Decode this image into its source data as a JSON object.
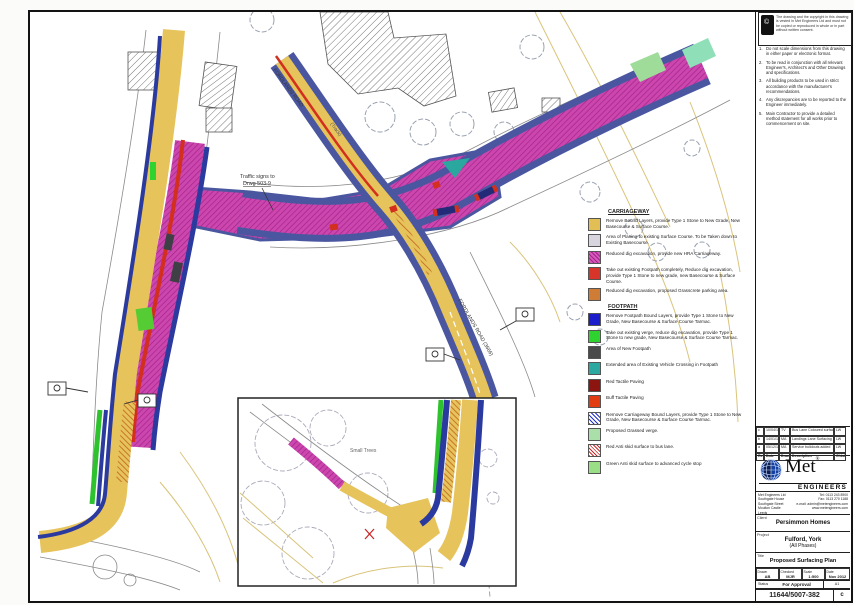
{
  "notes": {
    "copyright": "The drawing and the copyright in this drawing is vested in Met Engineers Ltd and must not be copied or reproduced in whole or in part without written consent.",
    "items": [
      {
        "n": "1.",
        "text": "Do not scale dimensions from this drawing in either paper or electronic format."
      },
      {
        "n": "2.",
        "text": "To be read in conjunction with all relevant Engineer's, Architect's and Other Drawings and specifications."
      },
      {
        "n": "3.",
        "text": "All building products to be used in strict accordance with the manufacturer's recommendations."
      },
      {
        "n": "4.",
        "text": "Any discrepancies are to be reported to the Engineer immediately."
      },
      {
        "n": "5.",
        "text": "Main Contractor to provide a detailed method statement for all works prior to commencement on site."
      }
    ]
  },
  "revisions": {
    "rows": [
      [
        "c",
        "10/04/13",
        "TV",
        "Bus Lane Coloured surface added",
        "LW"
      ],
      [
        "b",
        "14/01/13",
        "MA",
        "Landings Lane Surfacing Plan added",
        "LW"
      ],
      [
        "a",
        "05/12/12",
        "MA",
        "Service buildouts added",
        "LW"
      ]
    ],
    "footer": [
      "Rev",
      "Date",
      "Drawn",
      "Description",
      "Chkd"
    ]
  },
  "logo": {
    "name": "Met",
    "reg": "®",
    "sub": "ENGINEERS"
  },
  "company": {
    "lines": [
      "Met Engineers Ltd",
      "Southgate House",
      "Southgate Street",
      "Moulton Castle",
      "Leeds"
    ],
    "contact": [
      "Tel: 0113 243 8900",
      "Fax: 0113 270 1188",
      "e-mail: admin@metengineers.com",
      "www.metengineers.com"
    ]
  },
  "client": {
    "label": "Client",
    "name": "Persimmon Homes"
  },
  "project": {
    "label": "Project",
    "line1": "Fulford, York",
    "line2": "(All Phases)"
  },
  "title_block": {
    "label": "Title",
    "title": "Proposed Surfacing Plan",
    "drawn_label": "Drawn",
    "drawn": "AB",
    "checked_label": "Checked",
    "checked": "MJR",
    "scale_label": "Scale",
    "scale": "1:500",
    "date_label": "Date",
    "date1": "Nov 2012",
    "date2": "Nov 2012",
    "status_label": "Status",
    "status": "For Approval",
    "size_label": "Original Size",
    "size": "A1",
    "number_label": "Drawing No.",
    "number": "11644/5007-382",
    "rev_label": "Rev",
    "rev": "c"
  },
  "legend": {
    "carriageway": {
      "heading": "CARRIAGEWAY",
      "items": [
        {
          "color": "#e2bf55",
          "label": "Remove Bound Layers, provide Type 1 Stone to New Grade, New Basecourse & Surface Course."
        },
        {
          "color": "#d9d5de",
          "label": "Area of Planing to existing Surface Course. To be Taken down to Existing Basecourse."
        },
        {
          "color": "#cb46ad",
          "pattern": "magenta-hatch",
          "label": "Reduced dig excavation, provide new HRA Carriageway."
        },
        {
          "color": "#d8352a",
          "label": "Take out existing Footpath completely, Reduce dig excavation, provide Type 1 Stone to new grade, new Basecourse & Surface Course."
        },
        {
          "color": "#cf7d36",
          "label": "Reduced dig excavation, proposed Grasscrete parking area."
        }
      ]
    },
    "footpath": {
      "heading": "FOOTPATH",
      "items": [
        {
          "color": "#1c1ecb",
          "label": "Remove Footpath Bound Layers, provide Type 1 Stone to New Grade, New Basecourse & Surface Course Tarmac."
        },
        {
          "color": "#2fd32f",
          "label": "Take out existing verge, reduce dig excavation, provide Type 1 Stone to new grade, New Basecourse & Surface Course Tarmac."
        },
        {
          "color": "#4a4a4a",
          "label": "Area of New Footpath"
        },
        {
          "color": "#2ba8a0",
          "label": "Extended area of Existing Vehicle Crossing in Footpath"
        },
        {
          "color": "#8c1510",
          "label": "Red Tactile Paving"
        },
        {
          "color": "#e23d12",
          "label": "Buff Tactile Paving"
        },
        {
          "color": "#2233cc",
          "pattern": "blue-hatch",
          "label": "Remove Carriageway Bound Layers, provide Type 1 Stone to New Grade, New Basecourse & Surface Course Tarmac."
        },
        {
          "color": "#aadfaa",
          "label": "Proposed Grassed verge."
        },
        {
          "color": "#cc2a2a",
          "pattern": "red-hatch",
          "label": "Red Anti skid surface to bus lane."
        },
        {
          "color": "#9ade85",
          "label": "Green Anti skid surface to advanced cycle stop"
        }
      ]
    }
  },
  "plan": {
    "labels": {
      "road_upper": "FORDLANDS ROAD",
      "track": "(Track)",
      "road_lower": "FORDLANDS ROAD (3666)",
      "traffic_signs_1": "Traffic signs to",
      "traffic_signs_2": "Drwg 503-9",
      "inset_note": "Small Trees"
    }
  }
}
